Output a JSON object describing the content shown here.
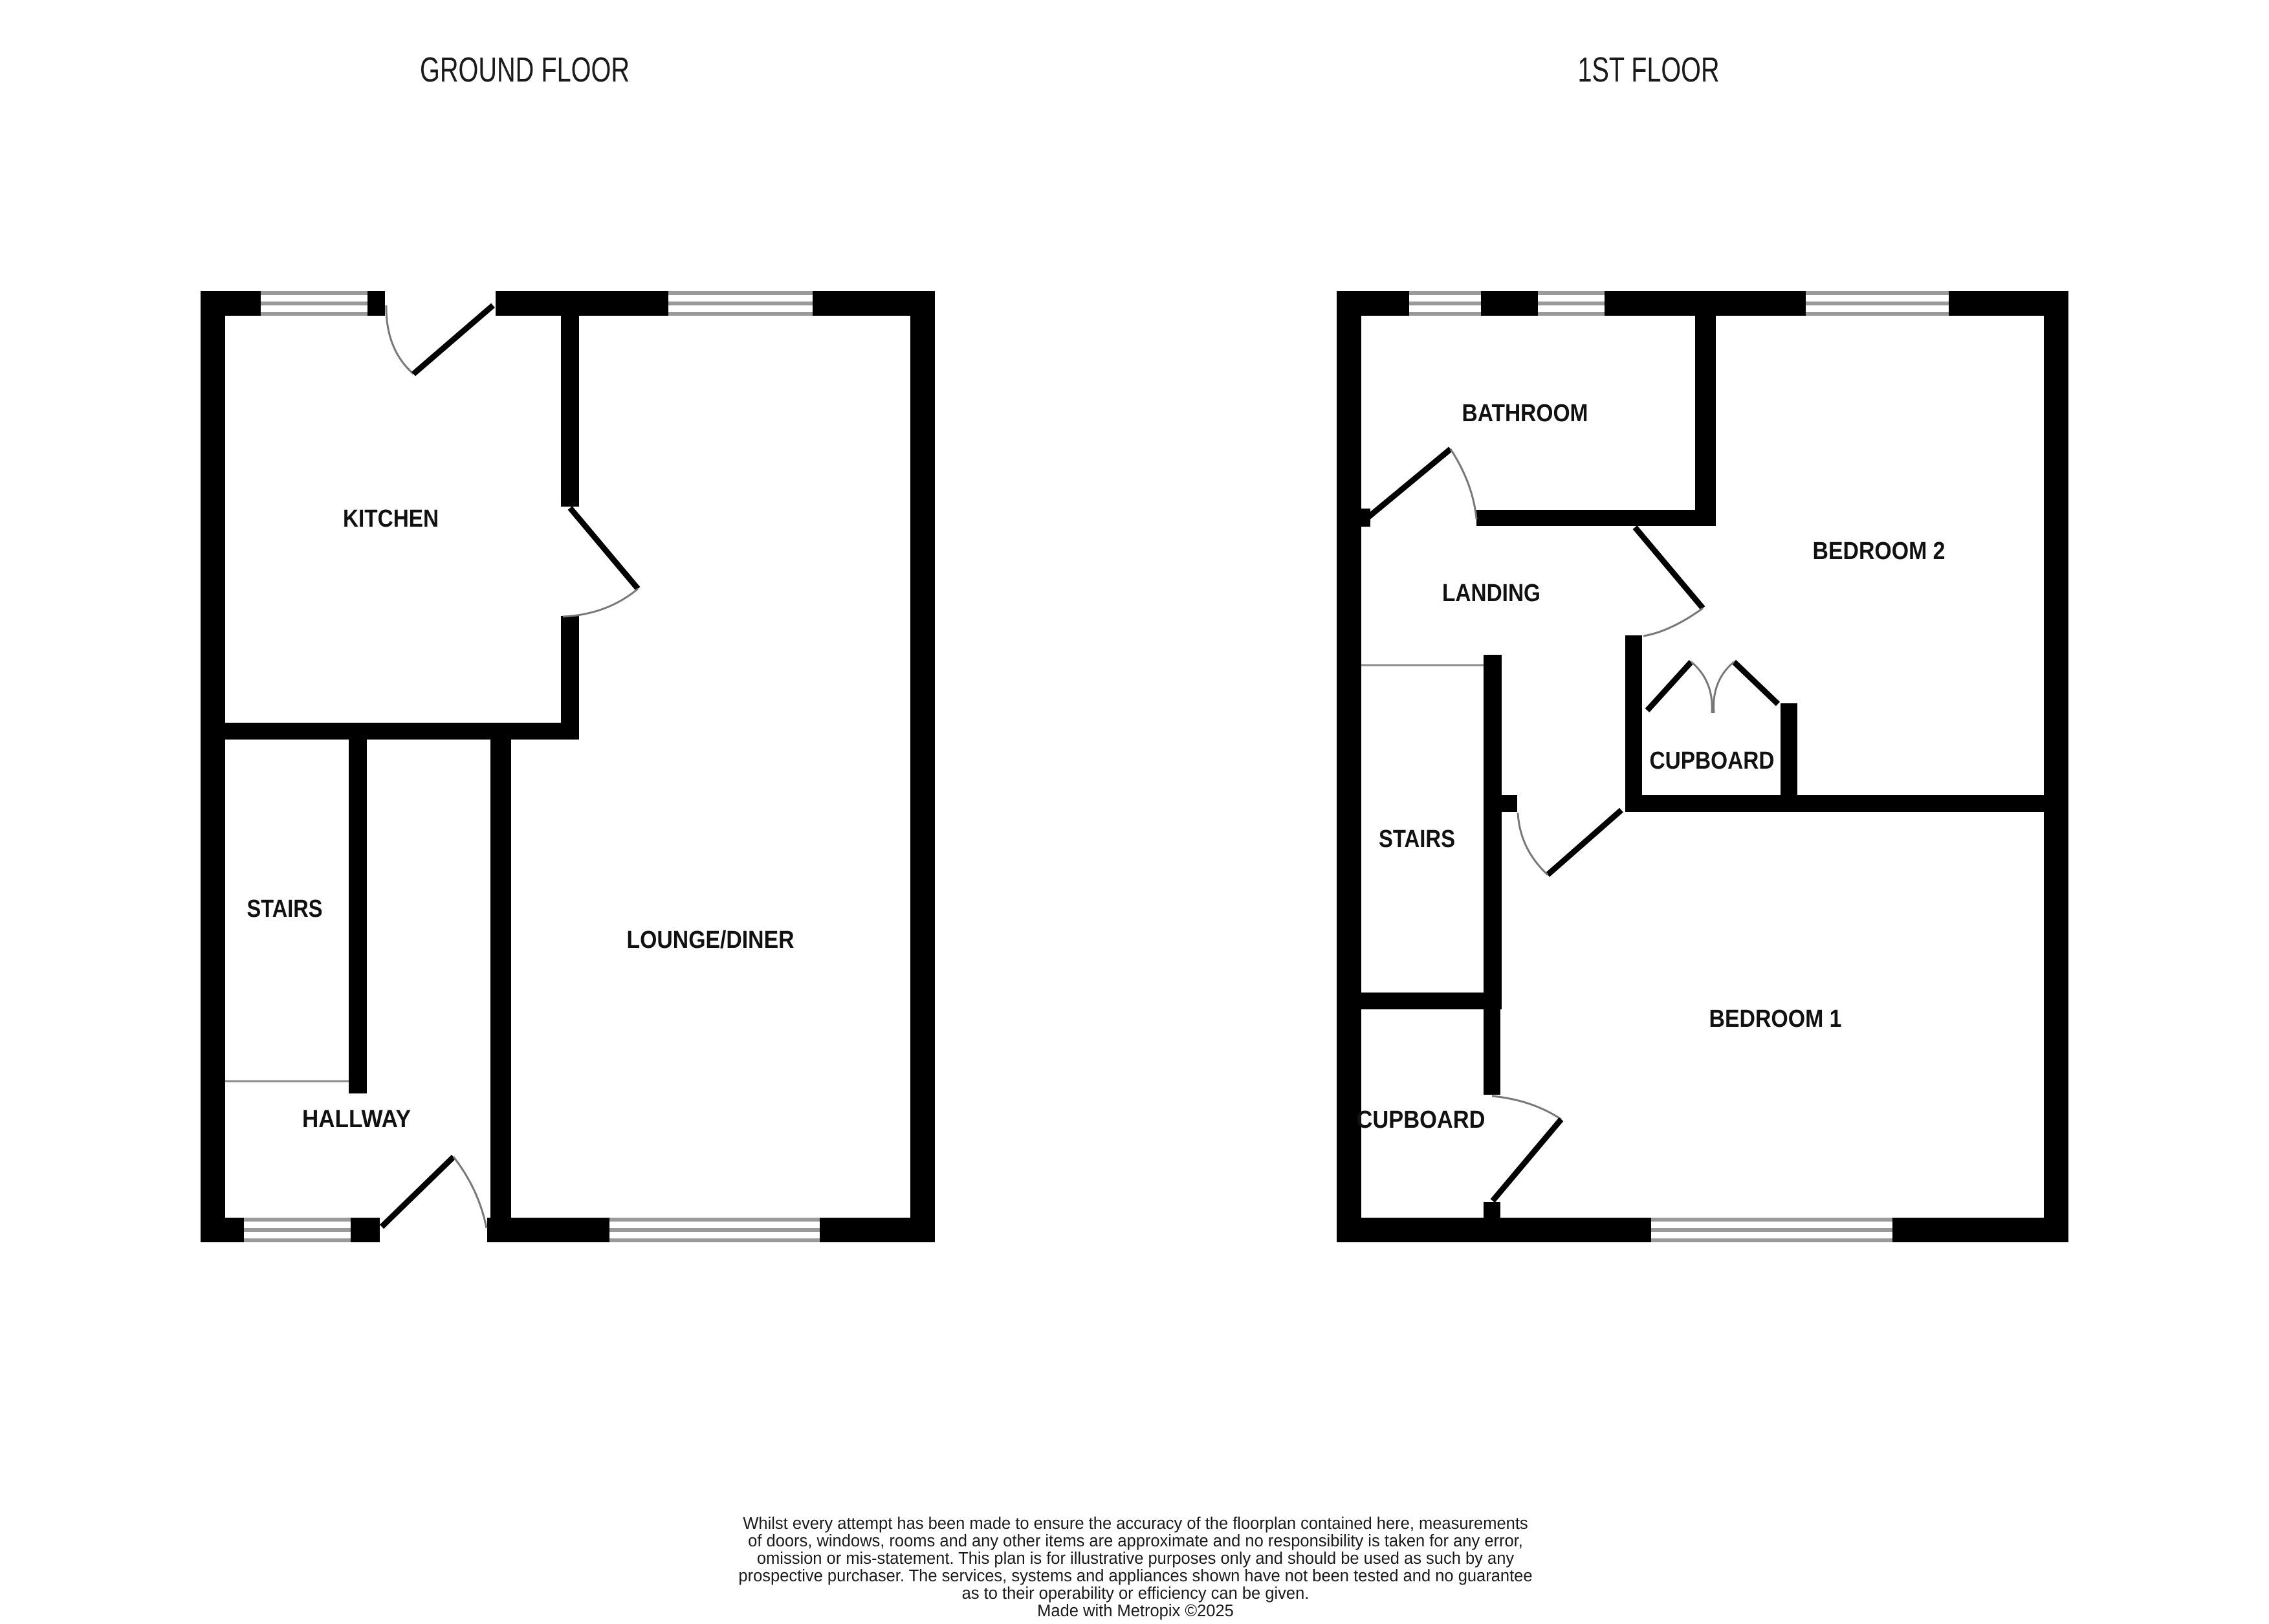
{
  "ground_floor": {
    "title": "GROUND FLOOR",
    "rooms": [
      {
        "label": "KITCHEN"
      },
      {
        "label": "STAIRS"
      },
      {
        "label": "HALLWAY"
      },
      {
        "label": "LOUNGE/DINER"
      }
    ]
  },
  "first_floor": {
    "title": "1ST FLOOR",
    "rooms": [
      {
        "label": "BATHROOM"
      },
      {
        "label": "LANDING"
      },
      {
        "label": "BEDROOM 2"
      },
      {
        "label": "CUPBOARD"
      },
      {
        "label": "STAIRS"
      },
      {
        "label": "BEDROOM 1"
      },
      {
        "label": "CUPBOARD"
      }
    ]
  },
  "disclaimer": {
    "lines": [
      "Whilst every attempt has been made to ensure the accuracy of the floorplan contained here, measurements",
      "of doors, windows, rooms and any other items are approximate and no responsibility is taken for any error,",
      "omission or mis-statement. This plan is for illustrative purposes only and should be used as such by any",
      "prospective purchaser. The services, systems and appliances shown have not been tested and no guarantee",
      "as to their operability or efficiency can be given.",
      "Made with Metropix ©2025"
    ]
  },
  "colors": {
    "wall": "#000000",
    "window_line": "#9a9a9a",
    "door_leaf": "#000000",
    "door_arc": "#777777",
    "stair_line": "#8c8c8c",
    "text": "#111111",
    "background": "#ffffff"
  }
}
